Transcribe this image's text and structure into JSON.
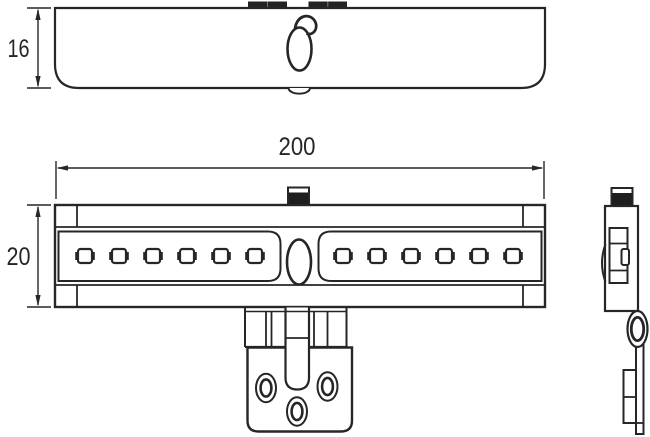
{
  "drawing": {
    "title": "LED cabinet light technical drawing",
    "dimensions": {
      "length": "200",
      "front_height": "20",
      "top_depth": "16"
    },
    "line_color": "#262626",
    "views": {
      "top_view": {
        "clip_count": 2,
        "knob": "rotary-sensor-knob"
      },
      "front_view": {
        "led_count_left": 6,
        "led_count_right": 6,
        "center_button": 1,
        "clip_count": 1
      },
      "bracket": {
        "screw_hole_count": 3
      },
      "side_view": {
        "clip_count": 1,
        "eyelet_count": 1
      }
    }
  }
}
